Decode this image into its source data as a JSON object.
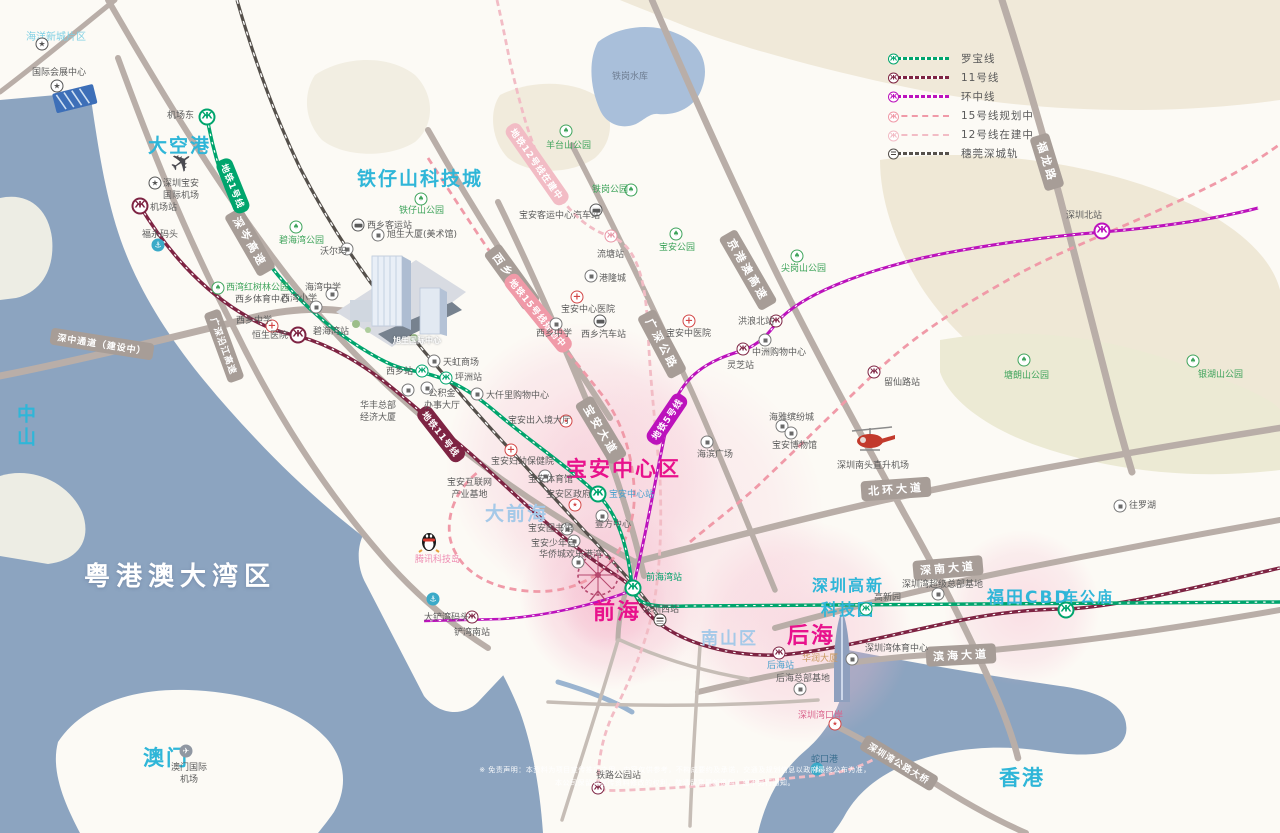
{
  "colors": {
    "sea": "#8CA4C0",
    "land": "#FCFAF5",
    "road": "#B9AEA8",
    "terrain": "#F0E9D9",
    "line1_green": "#00A56D",
    "line11_maroon": "#7E2443",
    "line5_magenta": "#BC12BC",
    "line15_pink": "#F09AA8",
    "line12_lightpink": "#F2BCC5",
    "rail_dark": "#55504B",
    "accent_magenta": "#E8128C",
    "accent_cyan": "#2FB6D8",
    "glow_pink": "#F5B8CD"
  },
  "icon_glyphs": {
    "m1": "Ж",
    "m11": "Ж",
    "m5": "Ж",
    "m12": "Ж",
    "tree": "♠",
    "star": "★",
    "cross": "+",
    "anchor": "⚓",
    "planec": "✈",
    "red": "★",
    "plane": "✈"
  },
  "legend": {
    "items": [
      {
        "label": "罗宝线",
        "color": "#00A56D",
        "style": "tick",
        "icon": "metro"
      },
      {
        "label": "11号线",
        "color": "#7E2443",
        "style": "tick",
        "icon": "metro"
      },
      {
        "label": "环中线",
        "color": "#BC12BC",
        "style": "tick",
        "icon": "metro"
      },
      {
        "label": "15号线规划中",
        "color": "#F09AA8",
        "style": "dash",
        "icon": "metro"
      },
      {
        "label": "12号线在建中",
        "color": "#F2BCC5",
        "style": "dash",
        "icon": "metro"
      },
      {
        "label": "穗莞深城轨",
        "color": "#55504B",
        "style": "tick",
        "icon": "rail"
      }
    ]
  },
  "disclaimer": {
    "line1": "※ 免责声明：本资料为项目宣传推广之用，内容仅供参考，不构成要约及承诺，交通及规划信息以政府最终公布为准，",
    "line2": "本公司保留对宣传资料修改的权利，敬请留意最新资料，恕不另行通知。"
  },
  "map": {
    "regions": [
      {
        "t": "海洋新城片区",
        "x": 26,
        "y": 28,
        "c": "cyanl",
        "s": 10
      },
      {
        "t": "大空港",
        "x": 148,
        "y": 131,
        "c": "cyan",
        "s": 19
      },
      {
        "t": "铁仔山科技城",
        "x": 357,
        "y": 164,
        "c": "cyan",
        "s": 19
      },
      {
        "t": "大前海",
        "x": 485,
        "y": 499,
        "c": "lblue",
        "s": 19
      },
      {
        "t": "宝安中心区",
        "x": 566,
        "y": 453,
        "c": "mag",
        "s": 21
      },
      {
        "t": "前海",
        "x": 593,
        "y": 594,
        "c": "mag",
        "s": 22
      },
      {
        "t": "后海",
        "x": 787,
        "y": 618,
        "c": "mag",
        "s": 22
      },
      {
        "t": "南山区",
        "x": 701,
        "y": 624,
        "c": "lblue",
        "s": 17
      },
      {
        "t": "深圳高新\n科技园",
        "x": 812,
        "y": 572,
        "c": "cyan ctr",
        "s": 16
      },
      {
        "t": "福田CBD",
        "x": 987,
        "y": 583,
        "c": "cyan",
        "s": 17
      },
      {
        "t": "车公庙",
        "x": 1063,
        "y": 586,
        "c": "cyan",
        "s": 15
      },
      {
        "t": "粤港澳大湾区",
        "x": 84,
        "y": 556,
        "c": "white",
        "s": 26
      },
      {
        "t": "中山",
        "x": 12,
        "y": 404,
        "c": "cyan vert",
        "s": 19
      },
      {
        "t": "澳门",
        "x": 143,
        "y": 742,
        "c": "cyan",
        "s": 21
      },
      {
        "t": "香港",
        "x": 999,
        "y": 762,
        "c": "cyan",
        "s": 21
      }
    ],
    "road_labels": [
      {
        "t": "深中通道（建设中）",
        "x": 102,
        "y": 344,
        "r": 9,
        "sm": true
      },
      {
        "t": "深岑高速",
        "x": 250,
        "y": 242,
        "r": 60
      },
      {
        "t": "广深沿江高速",
        "x": 224,
        "y": 346,
        "r": 70,
        "sm": true
      },
      {
        "t": "西乡大道",
        "x": 512,
        "y": 277,
        "r": 54
      },
      {
        "t": "宝安大道",
        "x": 601,
        "y": 430,
        "r": 59
      },
      {
        "t": "广深公路",
        "x": 662,
        "y": 344,
        "r": 62
      },
      {
        "t": "京港澳高速",
        "x": 748,
        "y": 270,
        "r": 60
      },
      {
        "t": "北环大道",
        "x": 896,
        "y": 489,
        "r": -4
      },
      {
        "t": "深南大道",
        "x": 948,
        "y": 568,
        "r": -5
      },
      {
        "t": "滨海大道",
        "x": 961,
        "y": 655,
        "r": -3
      },
      {
        "t": "福龙路",
        "x": 1047,
        "y": 162,
        "r": 73
      },
      {
        "t": "深圳湾公路大桥",
        "x": 899,
        "y": 763,
        "r": 31,
        "sm": true
      }
    ],
    "line_labels": [
      {
        "t": "地铁1号线",
        "x": 233,
        "y": 186,
        "r": 68,
        "bg": "#00A56D"
      },
      {
        "t": "地铁11号线",
        "x": 441,
        "y": 434,
        "r": 52,
        "bg": "#7E2443"
      },
      {
        "t": "地铁5号线",
        "x": 667,
        "y": 419,
        "r": -56,
        "bg": "#BC12BC"
      },
      {
        "t": "地铁15号线规划中",
        "x": 538,
        "y": 313,
        "r": 51,
        "bg": "#F09AA8"
      },
      {
        "t": "地铁12号线在建中",
        "x": 537,
        "y": 164,
        "r": 55,
        "bg": "#F2BCC5"
      }
    ],
    "icons": [
      {
        "t": "m1",
        "x": 207,
        "y": 117,
        "b": true,
        "n": "station-jichangdong"
      },
      {
        "t": "m1",
        "x": 422,
        "y": 371,
        "n": "station-xixiang"
      },
      {
        "t": "m1",
        "x": 446,
        "y": 378,
        "n": "station-pingzhou"
      },
      {
        "t": "m1",
        "x": 598,
        "y": 494,
        "b": true,
        "n": "station-baoanzhongxin"
      },
      {
        "t": "m1",
        "x": 633,
        "y": 588,
        "b": true,
        "n": "station-qianhaiwan"
      },
      {
        "t": "m1",
        "x": 866,
        "y": 609,
        "n": "station-gaoxinyuan"
      },
      {
        "t": "m1",
        "x": 1066,
        "y": 610,
        "b": true,
        "n": "station-chegongmiao"
      },
      {
        "t": "m11",
        "x": 140,
        "y": 206,
        "b": true,
        "n": "station-jichang"
      },
      {
        "t": "m11",
        "x": 298,
        "y": 335,
        "b": true,
        "n": "station-bihaiwan"
      },
      {
        "t": "m11",
        "x": 743,
        "y": 349,
        "n": "station-lingzhi"
      },
      {
        "t": "m11",
        "x": 776,
        "y": 321,
        "n": "station-honglangbei"
      },
      {
        "t": "m11",
        "x": 472,
        "y": 617,
        "n": "station-chanwannan"
      },
      {
        "t": "m11",
        "x": 598,
        "y": 788,
        "n": "station-tielugongyuan"
      },
      {
        "t": "m11",
        "x": 779,
        "y": 653,
        "n": "station-houhai"
      },
      {
        "t": "m11",
        "x": 874,
        "y": 372,
        "n": "station-liuxianlu"
      },
      {
        "t": "m5",
        "x": 1102,
        "y": 231,
        "b": true,
        "n": "station-shenzhenbei"
      },
      {
        "t": "m12",
        "x": 611,
        "y": 236,
        "n": "station-liutang"
      },
      {
        "t": "rail",
        "x": 660,
        "y": 620,
        "n": "station-shenzhenxi"
      },
      {
        "t": "plane",
        "x": 182,
        "y": 163,
        "n": "airplane"
      },
      {
        "t": "tree",
        "x": 296,
        "y": 227,
        "n": "park-bihaiwan"
      },
      {
        "t": "tree",
        "x": 421,
        "y": 199,
        "n": "park-tiezishan"
      },
      {
        "t": "tree",
        "x": 218,
        "y": 288,
        "n": "park-xiwanhongshulin"
      },
      {
        "t": "tree",
        "x": 631,
        "y": 190,
        "n": "park-tiegang"
      },
      {
        "t": "tree",
        "x": 566,
        "y": 131,
        "n": "park-yangtaishan"
      },
      {
        "t": "tree",
        "x": 676,
        "y": 234,
        "n": "park-baoan"
      },
      {
        "t": "tree",
        "x": 797,
        "y": 256,
        "n": "park-jiangangshan"
      },
      {
        "t": "tree",
        "x": 1024,
        "y": 360,
        "n": "park-tanglangshan"
      },
      {
        "t": "tree",
        "x": 1193,
        "y": 361,
        "n": "park-yinhushan"
      },
      {
        "t": "star",
        "x": 42,
        "y": 44,
        "n": "poi-haiyangxincheng"
      },
      {
        "t": "star",
        "x": 57,
        "y": 86,
        "n": "poi-huizhanzhongxin"
      },
      {
        "t": "star",
        "x": 155,
        "y": 183,
        "n": "poi-airport"
      },
      {
        "t": "cross",
        "x": 272,
        "y": 326,
        "n": "hospital-hengsheng"
      },
      {
        "t": "cross",
        "x": 511,
        "y": 450,
        "n": "hospital-fuyou"
      },
      {
        "t": "cross",
        "x": 577,
        "y": 297,
        "n": "hospital-baoanzhongxin"
      },
      {
        "t": "cross",
        "x": 689,
        "y": 321,
        "n": "hospital-baoanzhongyi"
      },
      {
        "t": "bus",
        "x": 358,
        "y": 225,
        "n": "bus-xixiangkeyun"
      },
      {
        "t": "bus",
        "x": 600,
        "y": 321,
        "n": "bus-xixiangqiche"
      },
      {
        "t": "bus",
        "x": 596,
        "y": 210,
        "n": "bus-baoankeyun"
      },
      {
        "t": "anchor",
        "x": 158,
        "y": 245,
        "n": "port-fuyong"
      },
      {
        "t": "anchor",
        "x": 433,
        "y": 599,
        "n": "port-dachanwan"
      },
      {
        "t": "anchor",
        "x": 817,
        "y": 769,
        "n": "port-shekou"
      },
      {
        "t": "planec",
        "x": 186,
        "y": 751,
        "n": "macau-airport"
      },
      {
        "t": "red",
        "x": 566,
        "y": 421,
        "n": "poi-churujing"
      },
      {
        "t": "red",
        "x": 575,
        "y": 505,
        "n": "poi-quzhengfu"
      },
      {
        "t": "red",
        "x": 835,
        "y": 724,
        "n": "poi-shenzhenwankouan"
      },
      {
        "t": "poi",
        "x": 347,
        "y": 249,
        "n": "poi-walmart"
      },
      {
        "t": "poi",
        "x": 378,
        "y": 235,
        "n": "poi-xushengdasha"
      },
      {
        "t": "poi",
        "x": 434,
        "y": 361,
        "n": "poi-tianhong"
      },
      {
        "t": "poi",
        "x": 477,
        "y": 394,
        "n": "poi-daqianli"
      },
      {
        "t": "poi",
        "x": 427,
        "y": 388,
        "n": "poi-gongjijin"
      },
      {
        "t": "poi",
        "x": 408,
        "y": 390,
        "n": "poi-huafeng"
      },
      {
        "t": "poi",
        "x": 591,
        "y": 276,
        "n": "poi-ganglongcheng"
      },
      {
        "t": "poi",
        "x": 765,
        "y": 340,
        "n": "poi-zhongzhou"
      },
      {
        "t": "poi",
        "x": 782,
        "y": 426,
        "n": "poi-haiya"
      },
      {
        "t": "poi",
        "x": 791,
        "y": 433,
        "n": "poi-bowuguan"
      },
      {
        "t": "poi",
        "x": 545,
        "y": 476,
        "n": "poi-tiyuguan"
      },
      {
        "t": "poi",
        "x": 602,
        "y": 516,
        "n": "poi-yifang"
      },
      {
        "t": "poi",
        "x": 567,
        "y": 529,
        "n": "poi-tushuguan"
      },
      {
        "t": "poi",
        "x": 574,
        "y": 541,
        "n": "poi-shaoniangong"
      },
      {
        "t": "poi",
        "x": 578,
        "y": 562,
        "n": "poi-huanlegangwan"
      },
      {
        "t": "poi",
        "x": 707,
        "y": 442,
        "n": "poi-haibinguangchang"
      },
      {
        "t": "poi",
        "x": 852,
        "y": 659,
        "n": "poi-huarun"
      },
      {
        "t": "poi",
        "x": 800,
        "y": 689,
        "n": "poi-houhaizongbu"
      },
      {
        "t": "poi",
        "x": 938,
        "y": 594,
        "n": "poi-chaojizongbu"
      },
      {
        "t": "poi",
        "x": 316,
        "y": 307,
        "n": "poi-xiwanxiaoxue"
      },
      {
        "t": "poi",
        "x": 332,
        "y": 294,
        "n": "poi-haiwanzhongxue"
      },
      {
        "t": "poi",
        "x": 556,
        "y": 324,
        "n": "poi-xixiangzhongxue2"
      },
      {
        "t": "poi",
        "x": 1120,
        "y": 506,
        "n": "poi-wangluohu"
      }
    ],
    "labels": [
      {
        "t": "国际会展中心",
        "x": 32,
        "y": 68
      },
      {
        "t": "机场东",
        "x": 167,
        "y": 111
      },
      {
        "t": "深圳宝安\n国际机场",
        "x": 163,
        "y": 179,
        "c": "ctr"
      },
      {
        "t": "机场站",
        "x": 150,
        "y": 203
      },
      {
        "t": "福永码头",
        "x": 142,
        "y": 230
      },
      {
        "t": "碧海湾公园",
        "x": 279,
        "y": 236,
        "c": "g"
      },
      {
        "t": "沃尔玛",
        "x": 320,
        "y": 247
      },
      {
        "t": "铁仔山公园",
        "x": 399,
        "y": 206,
        "c": "g"
      },
      {
        "t": "西乡客运站",
        "x": 367,
        "y": 221
      },
      {
        "t": "旭生大厦(美术馆)",
        "x": 387,
        "y": 230
      },
      {
        "t": "西湾红树林公园",
        "x": 226,
        "y": 283,
        "c": "g"
      },
      {
        "t": "西乡体育中心",
        "x": 235,
        "y": 295
      },
      {
        "t": "海湾中学",
        "x": 305,
        "y": 283
      },
      {
        "t": "西湾小学",
        "x": 281,
        "y": 294
      },
      {
        "t": "西乡中学",
        "x": 236,
        "y": 316
      },
      {
        "t": "恒生医院",
        "x": 252,
        "y": 331
      },
      {
        "t": "碧海湾站",
        "x": 313,
        "y": 327
      },
      {
        "t": "西乡站",
        "x": 386,
        "y": 367
      },
      {
        "t": "天虹商场",
        "x": 443,
        "y": 358
      },
      {
        "t": "坪洲站",
        "x": 455,
        "y": 373
      },
      {
        "t": "公积金\n办事大厅",
        "x": 424,
        "y": 389,
        "c": "ctr"
      },
      {
        "t": "华丰总部\n经济大厦",
        "x": 360,
        "y": 401,
        "c": "ctr"
      },
      {
        "t": "大仟里购物中心",
        "x": 486,
        "y": 391
      },
      {
        "t": "宝安出入境大厅",
        "x": 508,
        "y": 416
      },
      {
        "t": "宝安妇幼保健院",
        "x": 491,
        "y": 457
      },
      {
        "t": "宝安互联网\n产业基地",
        "x": 447,
        "y": 478,
        "c": "ctr"
      },
      {
        "t": "宝安体育馆",
        "x": 528,
        "y": 475
      },
      {
        "t": "宝安区政府",
        "x": 546,
        "y": 490
      },
      {
        "t": "宝安中心站",
        "x": 609,
        "y": 490,
        "c": "blue"
      },
      {
        "t": "壹方中心",
        "x": 595,
        "y": 520
      },
      {
        "t": "宝安图书馆",
        "x": 528,
        "y": 524
      },
      {
        "t": "宝安少年宫",
        "x": 531,
        "y": 539
      },
      {
        "t": "华侨城欢乐港湾",
        "x": 539,
        "y": 550
      },
      {
        "t": "流塘站",
        "x": 597,
        "y": 250
      },
      {
        "t": "港隆城",
        "x": 599,
        "y": 274
      },
      {
        "t": "宝安中心医院",
        "x": 561,
        "y": 305
      },
      {
        "t": "西乡中学",
        "x": 536,
        "y": 329
      },
      {
        "t": "西乡汽车站",
        "x": 581,
        "y": 330
      },
      {
        "t": "宝安中医院",
        "x": 666,
        "y": 329
      },
      {
        "t": "宝安公园",
        "x": 659,
        "y": 243,
        "c": "g"
      },
      {
        "t": "铁岗公园",
        "x": 592,
        "y": 185,
        "c": "g"
      },
      {
        "t": "宝安客运中心汽车站",
        "x": 519,
        "y": 211
      },
      {
        "t": "羊台山公园",
        "x": 546,
        "y": 141,
        "c": "g"
      },
      {
        "t": "尖岗山公园",
        "x": 781,
        "y": 264,
        "c": "g"
      },
      {
        "t": "洪浪北站",
        "x": 738,
        "y": 317
      },
      {
        "t": "中洲购物中心",
        "x": 752,
        "y": 348
      },
      {
        "t": "灵芝站",
        "x": 727,
        "y": 361
      },
      {
        "t": "海雅缤纷城",
        "x": 769,
        "y": 413
      },
      {
        "t": "宝安博物馆",
        "x": 772,
        "y": 441
      },
      {
        "t": "深圳南头直升机场",
        "x": 837,
        "y": 461
      },
      {
        "t": "留仙路站",
        "x": 884,
        "y": 378
      },
      {
        "t": "塘朗山公园",
        "x": 1004,
        "y": 371,
        "c": "g"
      },
      {
        "t": "银湖山公园",
        "x": 1198,
        "y": 370,
        "c": "g"
      },
      {
        "t": "深圳北站",
        "x": 1066,
        "y": 211
      },
      {
        "t": "海滨广场",
        "x": 697,
        "y": 450
      },
      {
        "t": "往罗湖",
        "x": 1129,
        "y": 501
      },
      {
        "t": "深圳湾超级总部基地",
        "x": 902,
        "y": 580
      },
      {
        "t": "高新园",
        "x": 874,
        "y": 593
      },
      {
        "t": "深圳湾体育中心",
        "x": 865,
        "y": 644
      },
      {
        "t": "后海站",
        "x": 767,
        "y": 661,
        "c": "blue"
      },
      {
        "t": "华润大厦",
        "x": 802,
        "y": 654,
        "c": "tan"
      },
      {
        "t": "后海总部基地",
        "x": 776,
        "y": 674
      },
      {
        "t": "深圳湾口岸",
        "x": 798,
        "y": 711,
        "c": "pk2"
      },
      {
        "t": "蛇口港",
        "x": 811,
        "y": 755,
        "c": "teal"
      },
      {
        "t": "铁路公园站",
        "x": 596,
        "y": 771
      },
      {
        "t": "深圳西站",
        "x": 643,
        "y": 605
      },
      {
        "t": "前海湾站",
        "x": 646,
        "y": 573,
        "c": "green"
      },
      {
        "t": "大铲湾码头",
        "x": 424,
        "y": 613
      },
      {
        "t": "铲湾南站",
        "x": 454,
        "y": 628
      },
      {
        "t": "澳门国际\n机场",
        "x": 171,
        "y": 763,
        "c": "ctr"
      },
      {
        "t": "腾讯科技岛",
        "x": 415,
        "y": 555,
        "c": "pink"
      },
      {
        "t": "铁岗水库",
        "x": 612,
        "y": 72,
        "c": "lake"
      },
      {
        "t": "旭生国际中心",
        "x": 393,
        "y": 336,
        "c": "white"
      }
    ]
  }
}
